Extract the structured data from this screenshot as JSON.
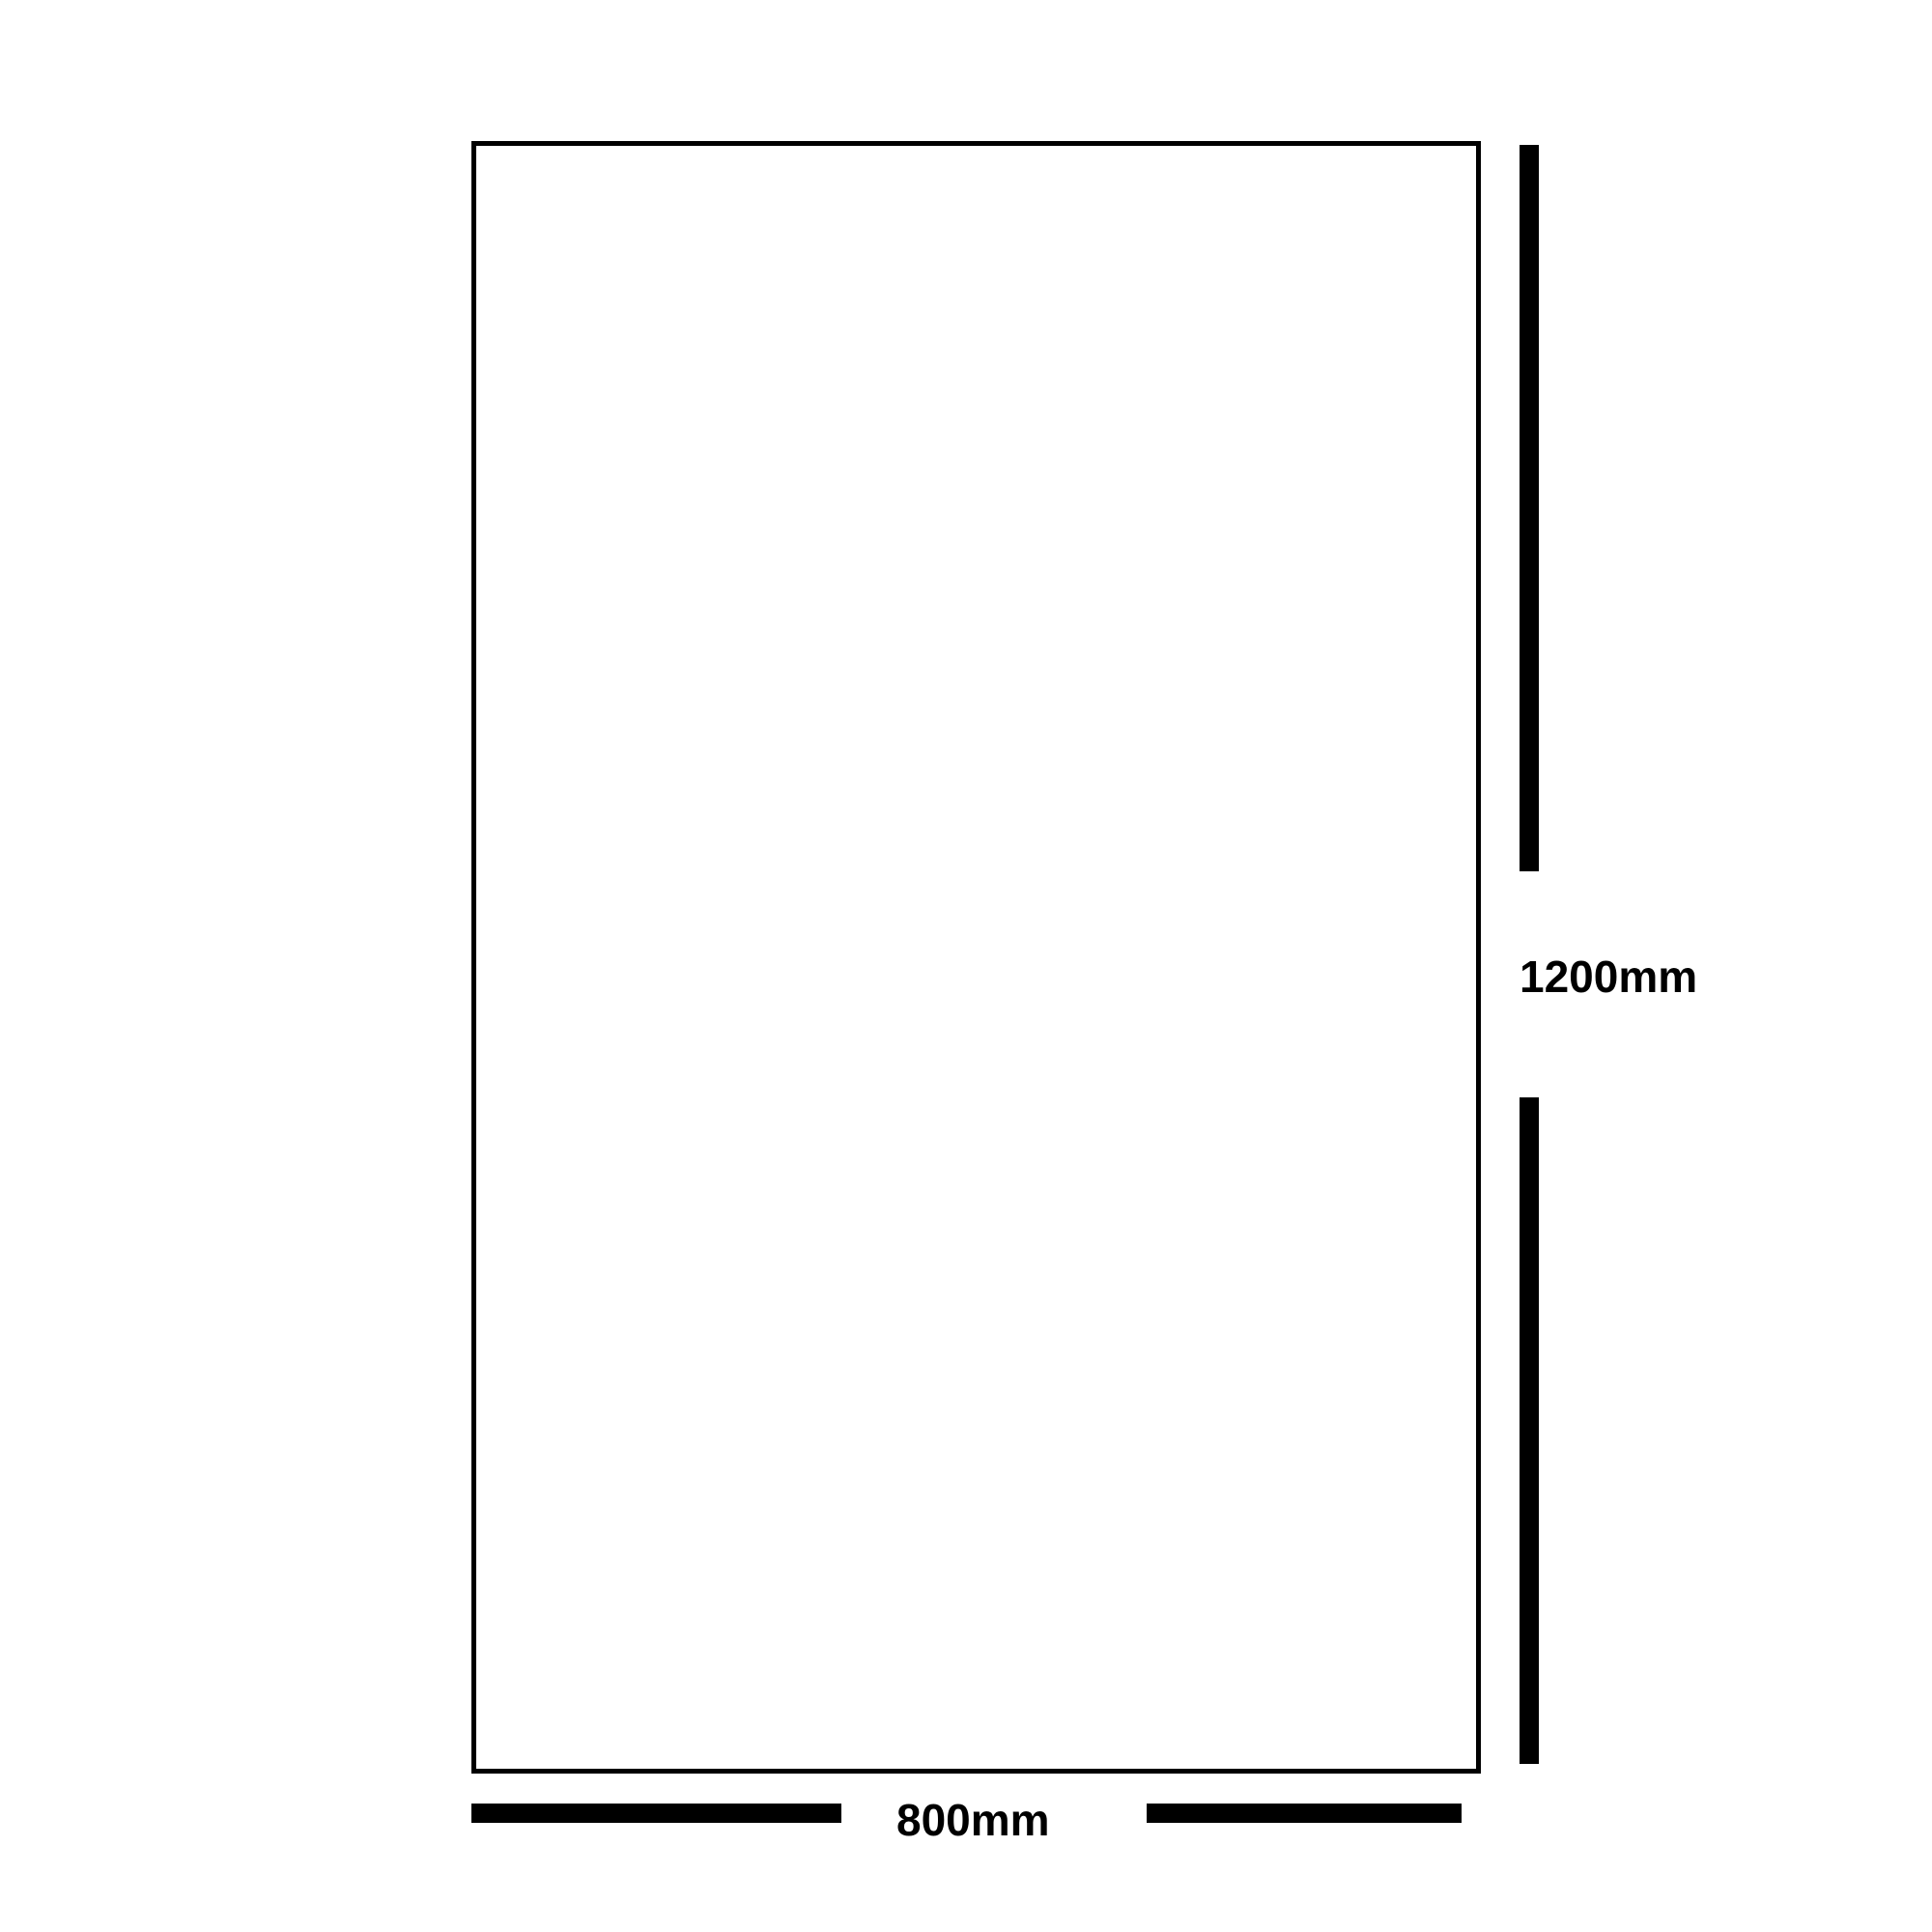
{
  "diagram": {
    "type": "dimension-drawing",
    "shape": "rectangle-outline",
    "height_label": "1200mm",
    "width_label": "800mm",
    "height_value_mm": 1200,
    "width_value_mm": 800,
    "colors": {
      "line": "#000000",
      "background": "#ffffff"
    }
  }
}
